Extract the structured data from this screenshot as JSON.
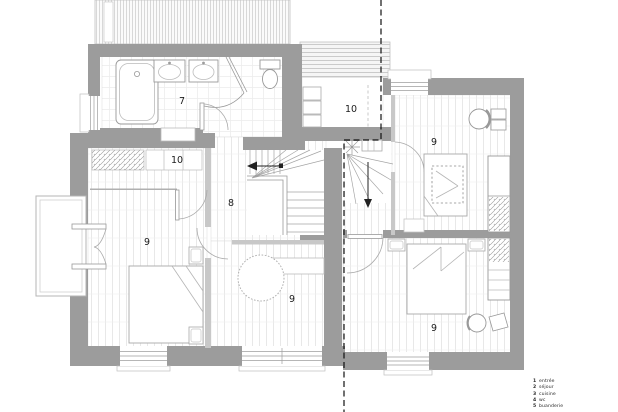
{
  "plan": {
    "type_note": "first floor plan drawing",
    "rooms": {
      "bathroom": {
        "number": "7"
      },
      "hall": {
        "number": "8"
      },
      "bedroom_left": {
        "number": "9"
      },
      "bedroom_middle": {
        "number": "9"
      },
      "bedroom_top_right": {
        "number": "9"
      },
      "bedroom_bottom_right": {
        "number": "9"
      },
      "dressing_left": {
        "number": "10"
      },
      "storage_top": {
        "number": "10"
      }
    },
    "palette": {
      "wall": "#9c9c9c",
      "partition": "#c8c8c8",
      "fixture_line": "#999999",
      "floor_hatch": "#e3e3e3",
      "section_line": "#111111"
    }
  },
  "legend": {
    "items": [
      {
        "number": "1",
        "label": "entrée"
      },
      {
        "number": "2",
        "label": "séjour"
      },
      {
        "number": "3",
        "label": "cuisine"
      },
      {
        "number": "4",
        "label": "wc"
      },
      {
        "number": "5",
        "label": "buanderie"
      }
    ]
  }
}
